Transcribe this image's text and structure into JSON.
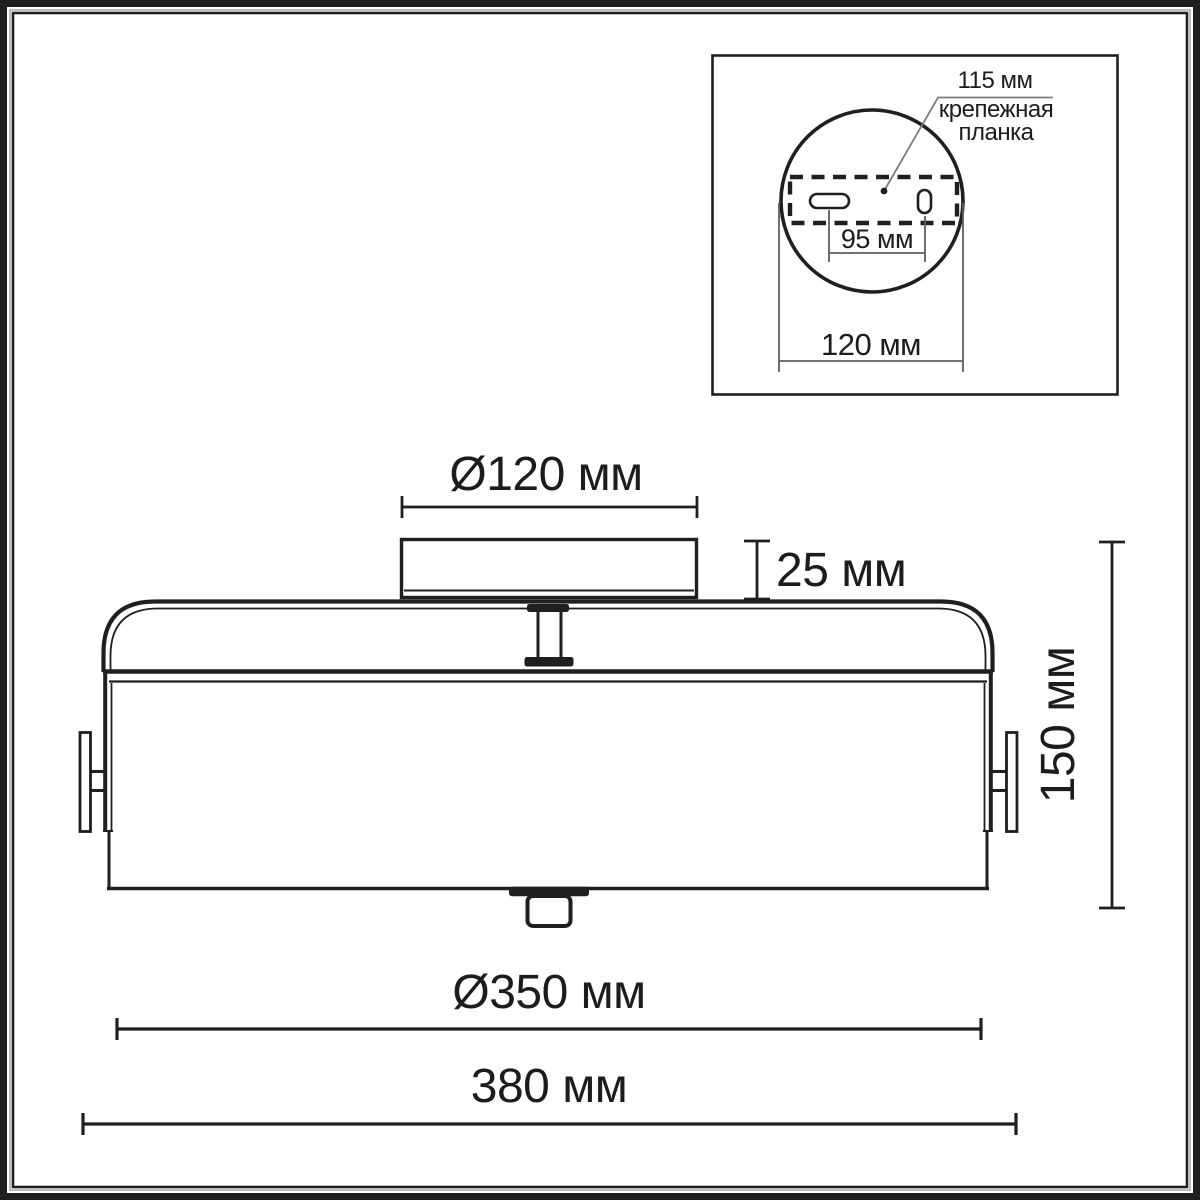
{
  "colors": {
    "ink": "#1f1f1f",
    "leader_gray": "#7d7d7d",
    "background": "#ffffff"
  },
  "labels": {
    "main_view": {
      "canopy_diameter": "Ø120 мм",
      "canopy_height": "25 мм",
      "body_height": "150 мм",
      "shade_diameter": "Ø350 мм",
      "overall_width": "380 мм"
    },
    "inset_view": {
      "plate_length": "115 мм",
      "bracket_name_line1": "крепежная",
      "bracket_name_line2": "планка",
      "hole_spacing": "95 мм",
      "plate_diameter": "120 мм"
    }
  }
}
